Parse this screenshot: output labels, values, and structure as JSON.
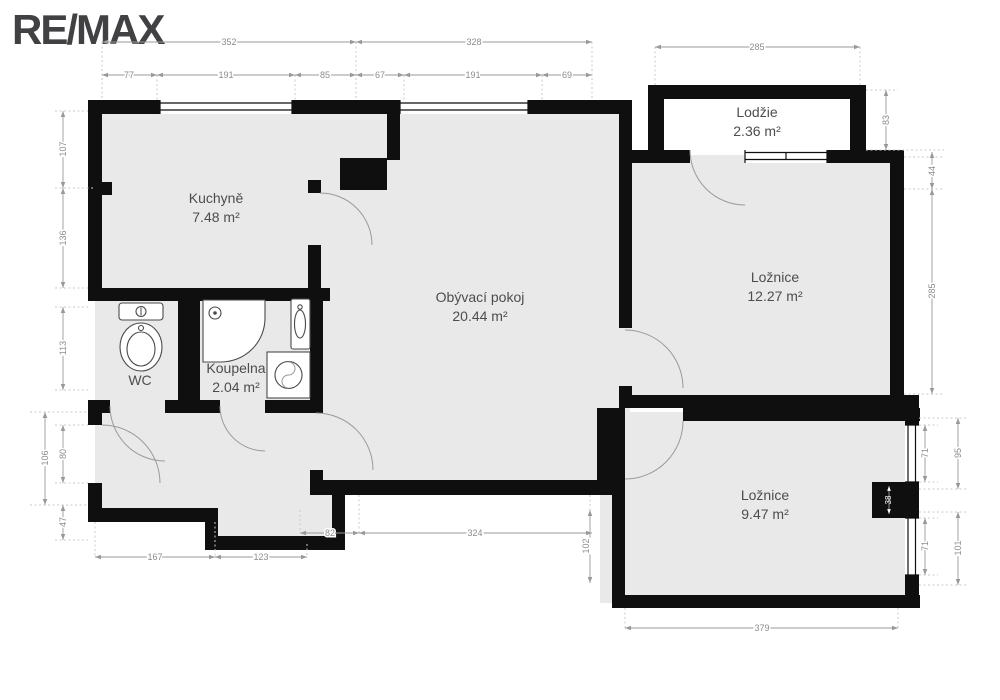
{
  "brand": {
    "logo_text": "RE/MAX"
  },
  "rooms": {
    "kitchen": {
      "name": "Kuchyně",
      "area": "7.48 m²"
    },
    "living_room": {
      "name": "Obývací pokoj",
      "area": "20.44 m²"
    },
    "loggia": {
      "name": "Lodžie",
      "area": "2.36 m²"
    },
    "bedroom1": {
      "name": "Ložnice",
      "area": "12.27 m²"
    },
    "bedroom2": {
      "name": "Ložnice",
      "area": "9.47 m²"
    },
    "bathroom": {
      "name": "Koupelna",
      "area": "2.04 m²"
    },
    "wc": {
      "name": "WC"
    }
  },
  "dimensions_cm": {
    "top": {
      "d352": "352",
      "d328": "328",
      "d285": "285",
      "d77": "77",
      "d191a": "191",
      "d85": "85",
      "d67": "67",
      "d191b": "191",
      "d69": "69"
    },
    "left": {
      "d107": "107",
      "d136": "136",
      "d113": "113",
      "d106": "106",
      "d80": "80",
      "d47": "47"
    },
    "right": {
      "d83": "83",
      "d44": "44",
      "d285": "285",
      "d71a": "71",
      "d95": "95",
      "d38": "38",
      "d71b": "71",
      "d101": "101"
    },
    "bottom": {
      "d167": "167",
      "d123": "123",
      "d82": "82",
      "d324": "324",
      "d102": "102",
      "d379": "379"
    }
  },
  "colors": {
    "wall": "#0f0f0f",
    "room_fill": "#e9e9e9",
    "loggia_fill": "#ffffff",
    "dimension": "#999999",
    "room_label": "#4d4d4d",
    "logo": "#414042"
  }
}
